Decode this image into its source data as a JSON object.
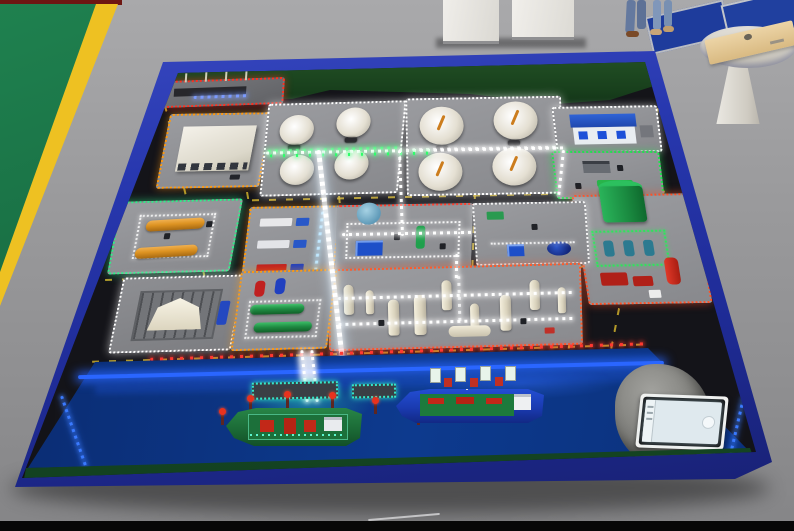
{
  "scene": {
    "type": "photograph",
    "subject": "Physical scale model of an LNG / petrochemical marine terminal with LED-lit equipment pads, displayed on a large blue table",
    "environment": "workshop floor with green safety walkway, white display boards, blue panels, round pedestal table and two partially visible people at the top edge"
  },
  "floor": {
    "concrete_color": "#9a9a9c",
    "walkway_color": "#1e7a50",
    "stripe_color": "#f0c022",
    "baseboard_color": "#6e1612",
    "bottom_strip_color": "#070707"
  },
  "model": {
    "table_frame_color": "#2534a8",
    "ground_color": "#17171b",
    "grass_color": "#1c4723",
    "water_color": "#0c307c",
    "road_dash_color": "#d9b92c",
    "zones": [
      {
        "name": "truck-loading-gantry",
        "led_color": "#ff3020"
      },
      {
        "name": "warehouse",
        "led_color": "#ff9a10",
        "building_color": "#efece3"
      },
      {
        "name": "storage-tank-farm-small",
        "tanks": 4,
        "led_color": "#ffffff"
      },
      {
        "name": "storage-tank-farm-large",
        "tanks": 4,
        "led_color": "#ffffff"
      },
      {
        "name": "admin-building",
        "building_color": "#2458c8",
        "led_color": "#ffffff"
      },
      {
        "name": "utility-area",
        "led_color": "#22e050"
      },
      {
        "name": "green-tank-process-area",
        "tank_color": "#22a24e",
        "led_color": "#ff5026"
      },
      {
        "name": "horizontal-vessel-area",
        "vessels": 2,
        "vessel_color": "#e09422",
        "led_color": "#2ef08a"
      },
      {
        "name": "pump-station",
        "led_color": "#ff9a10"
      },
      {
        "name": "process-unit-a",
        "led_color": "#ffffff"
      },
      {
        "name": "process-unit-b",
        "led_color": "#ffffff"
      },
      {
        "name": "distillation-column-unit",
        "columns": 9,
        "led_color": "#ff5a2a"
      },
      {
        "name": "covered-pit",
        "led_color": "#ffffff"
      },
      {
        "name": "green-vessel-skid",
        "vessels": 2,
        "led_color": "#ff9a10"
      }
    ],
    "pipeline_led_color": "#ffffff",
    "harbor": {
      "quay_led_color": "#2a66ff",
      "jetty_led_color": "#2fe8c4",
      "ships": [
        {
          "name": "tanker-green",
          "hull_color": "#1f7a40",
          "deck_equipment_color": "#c22818"
        },
        {
          "name": "tanker-blue",
          "hull_color": "#1d46c8",
          "deck_color": "#1d7a3c"
        }
      ],
      "island": "rocky outcrop carrying the control tablet"
    },
    "tablet": {
      "frame_color": "#f2f2f0",
      "bezel_color": "#101012",
      "screen_color": "#dfe9ee",
      "button_color": "#39e05e",
      "button_rows": 7,
      "button_cols": 4
    }
  }
}
